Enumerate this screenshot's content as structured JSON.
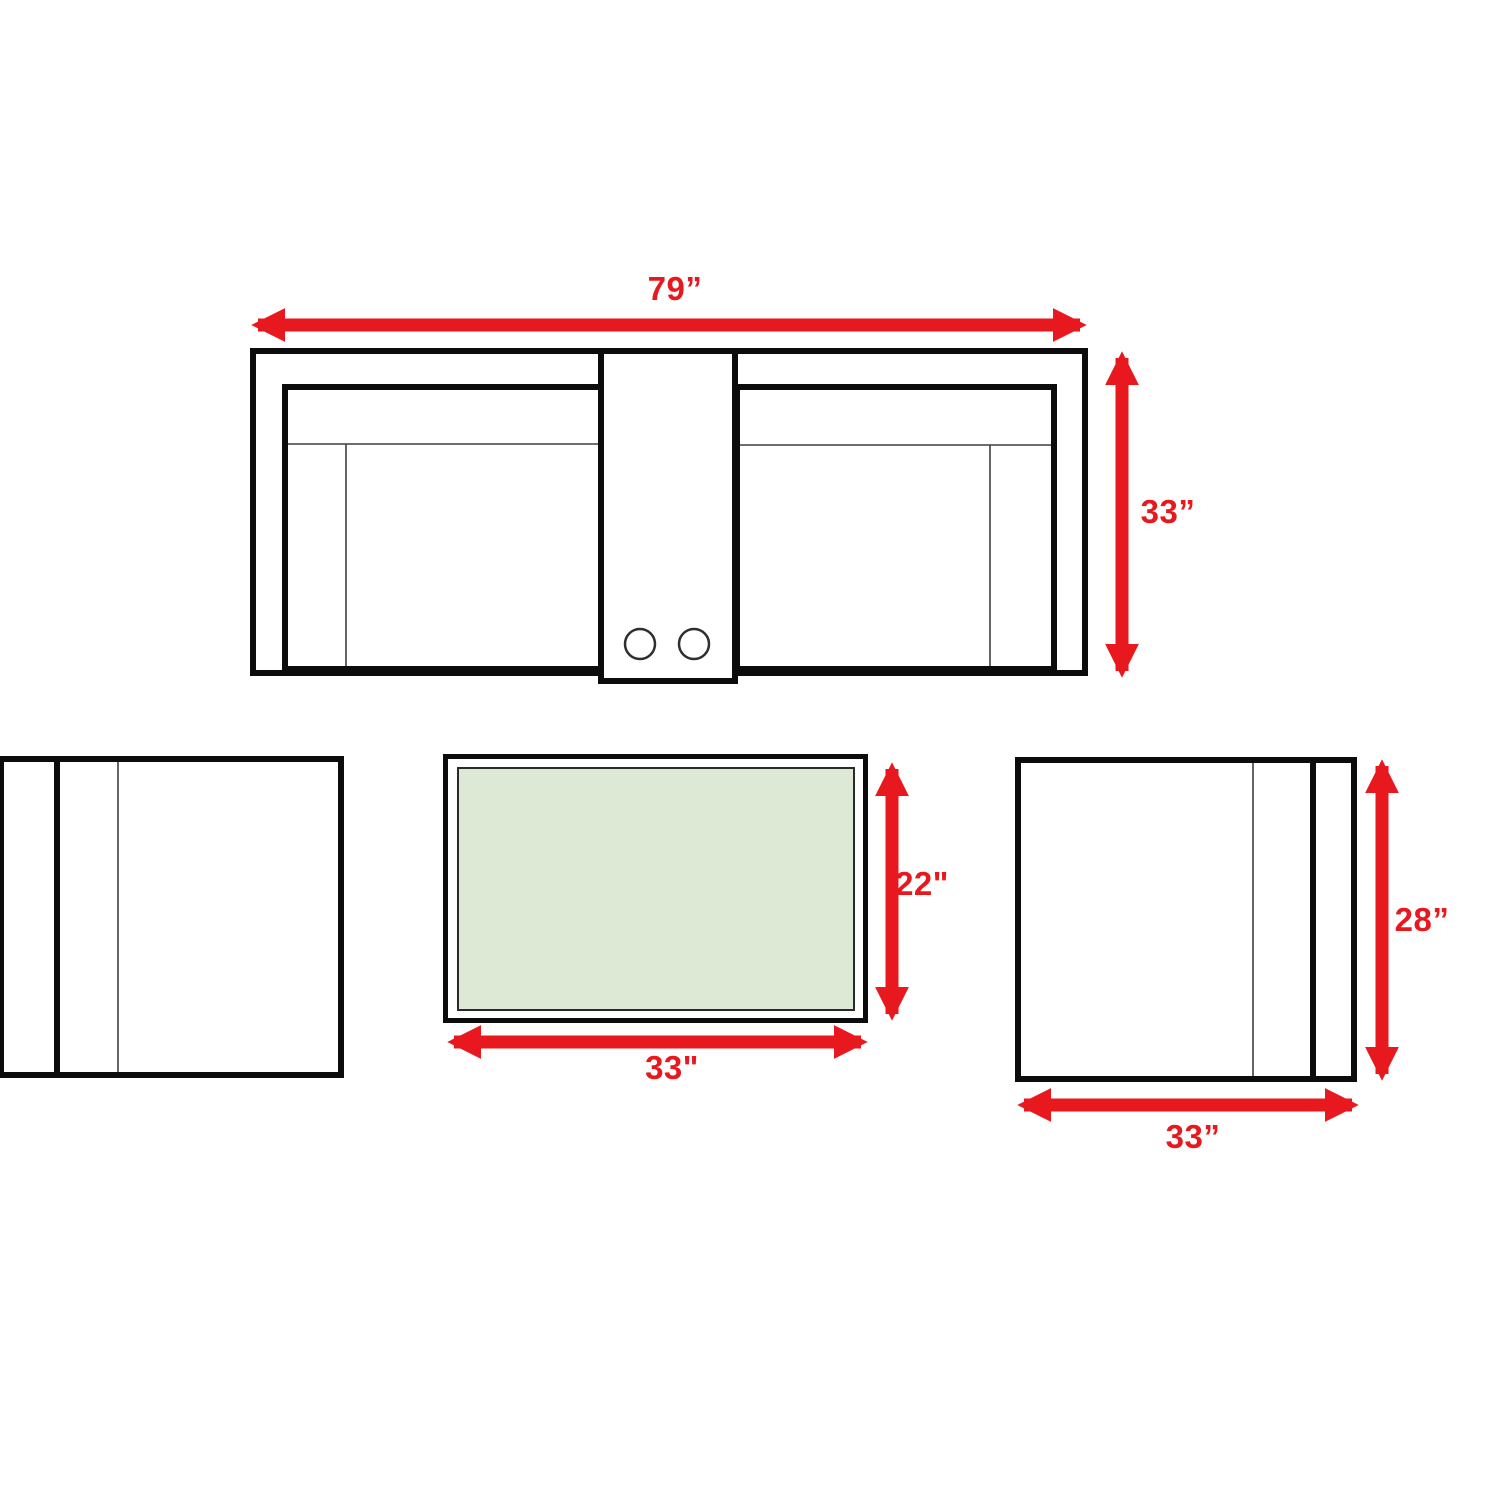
{
  "title": "Patio furniture set dimensions (top view)",
  "colors": {
    "accent_red": "#e8191e",
    "table_glass_green": "#dee9d5",
    "outline_black": "#0c0c0c"
  },
  "items": {
    "sofa": {
      "name": "loveseat with center console, top view",
      "cupholder_count": 2,
      "width_label": "79”",
      "depth_label": "33”"
    },
    "left_chair": {
      "name": "club chair, top view (partially cropped at left edge)"
    },
    "coffee_table": {
      "name": "glass-top coffee table, top view",
      "width_label": "33\"",
      "depth_label": "22\""
    },
    "right_chair": {
      "name": "club chair, top view",
      "width_label": "33”",
      "depth_label": "28”"
    }
  }
}
